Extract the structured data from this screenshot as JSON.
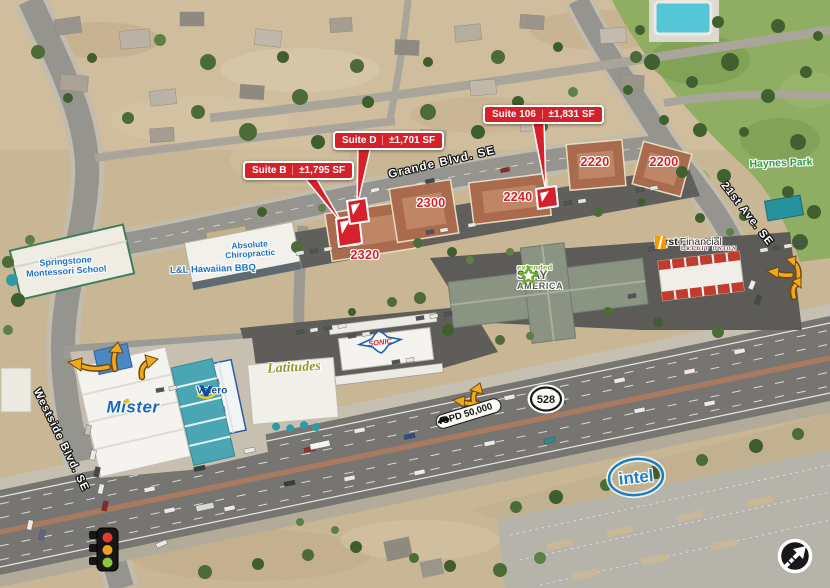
{
  "annotations": {
    "divider": "|",
    "suites": [
      {
        "name": "Suite B",
        "area": "±1,795 SF"
      },
      {
        "name": "Suite D",
        "area": "±1,701 SF"
      },
      {
        "name": "Suite 106",
        "area": "±1,831 SF"
      }
    ],
    "buildings": [
      "2320",
      "2300",
      "2240",
      "2220",
      "2200"
    ],
    "streets": {
      "grande": "Grande Blvd. SE",
      "twenty_first": "21st Ave. SE",
      "westside": "Westside Blvd. SE"
    },
    "route_shield": "528",
    "traffic_count": "CPD 50,000",
    "park": "Haynes Park"
  },
  "tenants": {
    "springstone": {
      "line1": "Springstone",
      "line2": "Montessori School"
    },
    "absolute": {
      "line1": "Absolute",
      "line2": "Chiropractic"
    },
    "ll_bbq": "L&L Hawaiian BBQ",
    "first_financial": {
      "first": "First",
      "financial": "Financial",
      "credit_union": "CREDIT UNION"
    },
    "extended_stay": {
      "extended": "extended",
      "stay": "STAY",
      "america": "AMERICA"
    },
    "mister": "Mister",
    "valero": "Valero",
    "latitudes": "Latitudes",
    "sonic": "SONIC",
    "intel": "intel"
  },
  "colors": {
    "callout_red": "#D7212A",
    "number_red": "#D7212A",
    "label_blue": "#1B74C8",
    "park_green": "#2E9E3C",
    "arrow_yellow": "#F2A91D",
    "ff_orange": "#F59B00",
    "esa_green": "#6FAE28",
    "valero_blue": "#0C4DA2",
    "sonic_red": "#E02020",
    "sonic_blue": "#1560BD",
    "mister_blue": "#1668C0",
    "intel_blue": "#1B7EC2",
    "latitudes_olive": "#97972E"
  }
}
